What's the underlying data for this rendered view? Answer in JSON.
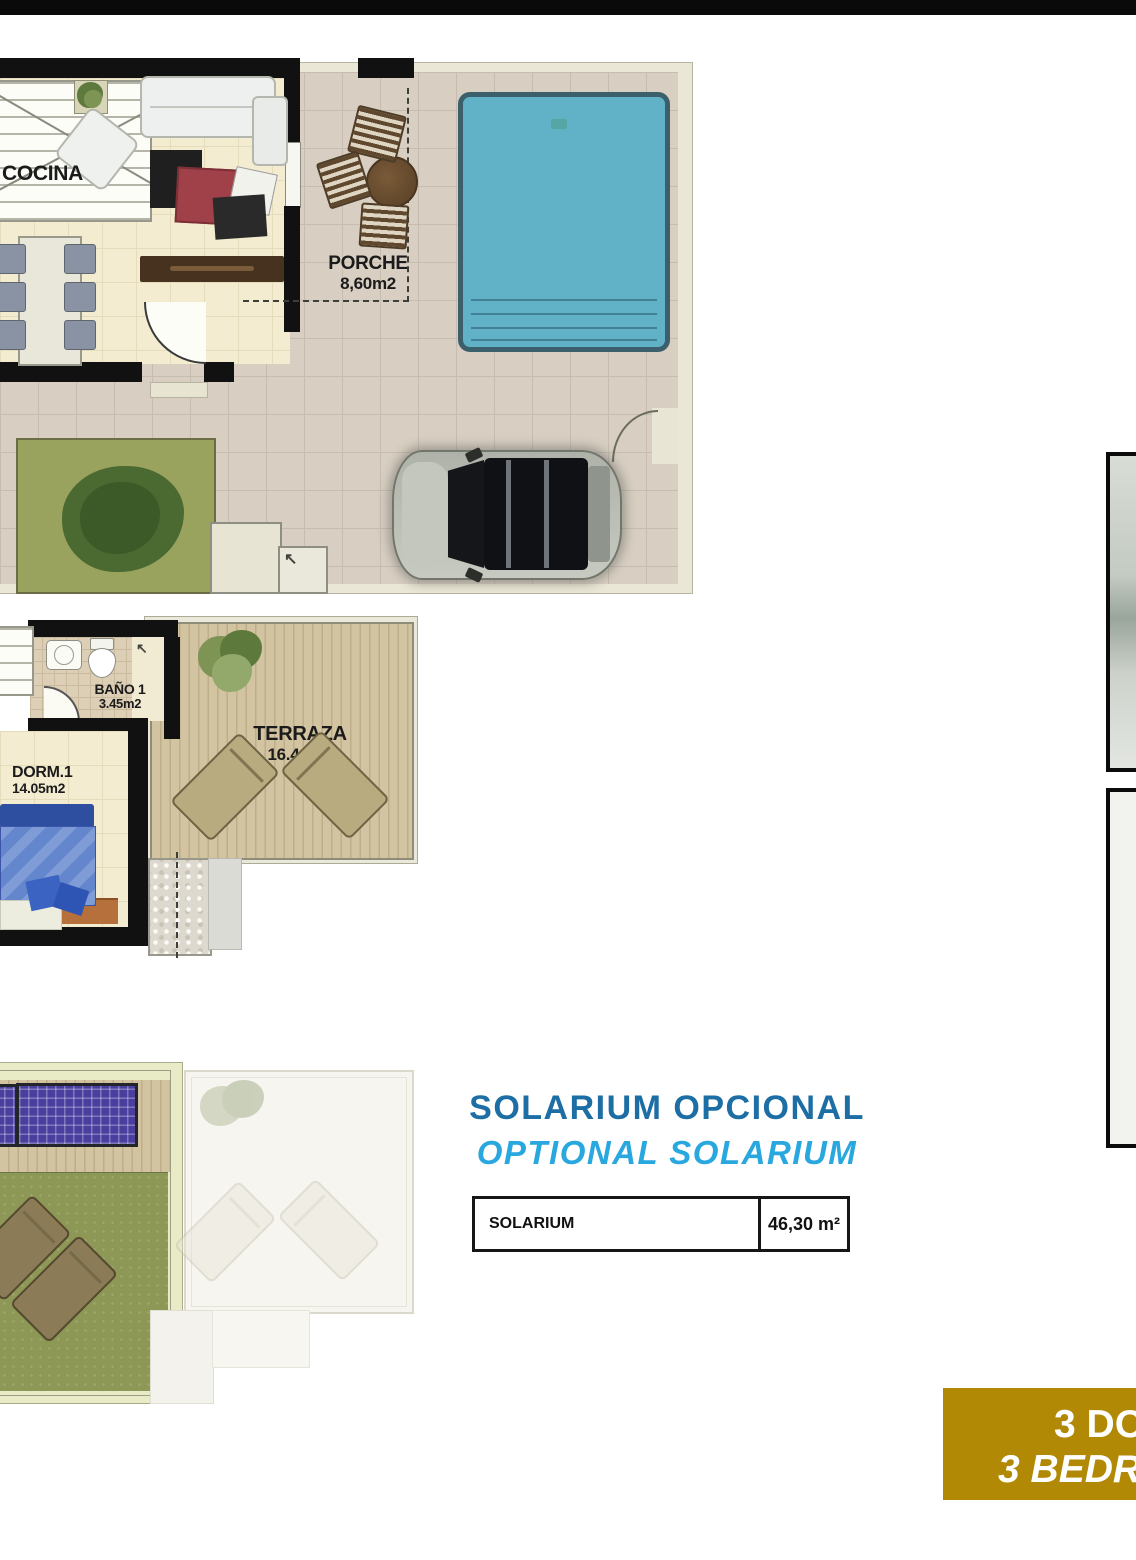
{
  "ground_floor": {
    "cocina_label": "COCINA",
    "porche_label": "PORCHE",
    "porche_area": "8,60m2",
    "entry_arrow": "↖"
  },
  "first_floor": {
    "bano_label": "BAÑO 1",
    "bano_area": "3.45m2",
    "terraza_label": "TERRAZA",
    "terraza_area": "16.40m2",
    "dorm_label": "DORM.1",
    "dorm_area": "14.05m2",
    "entry_arrow": "↖"
  },
  "solarium_block": {
    "title_es": "SOLARIUM OPCIONAL",
    "title_en": "OPTIONAL SOLARIUM",
    "table": {
      "label": "SOLARIUM",
      "value": "46,30 m²"
    }
  },
  "banner": {
    "line1": "3 DO",
    "line2": "3 BEDR"
  },
  "colors": {
    "title_dark_blue": "#1c6ea4",
    "title_light_blue": "#29a7df",
    "banner_gold": "#b28905",
    "pool_water": "#61b2c7",
    "grass_green": "#8d9857",
    "solar_panel_purple": "#4a3e9f",
    "wall_black": "#111111",
    "tile_beige": "#d8cfc2",
    "wood_deck": "#cfbf9e"
  }
}
